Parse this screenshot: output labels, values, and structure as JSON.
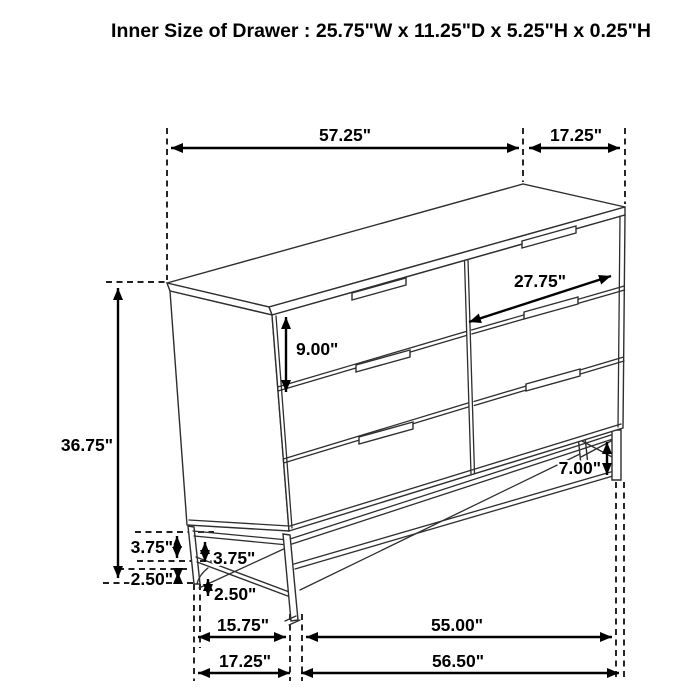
{
  "title": {
    "text": "Inner Size of Drawer : 25.75\"W x 11.25\"D x 5.25\"H x 0.25\"H"
  },
  "figure": {
    "kind": "isometric-line-drawing",
    "subject": "six-drawer dresser on metal leg base",
    "drawer_count_visible": 6,
    "line_color": "#2e2e2e",
    "dimension_color": "#000000",
    "background": "#ffffff"
  },
  "dims": {
    "top_width": "57.25\"",
    "top_depth": "17.25\"",
    "drawer_width": "27.75\"",
    "drawer_front_height": "9.00\"",
    "overall_height": "36.75\"",
    "leg_height_right": "7.00\"",
    "left_upper_outer": "3.75\"",
    "left_upper_inner": "3.75\"",
    "left_lower_outer": "2.50\"",
    "left_lower_inner": "2.50\"",
    "base_depth": "15.75\"",
    "base_width": "55.00\"",
    "floor_depth": "17.25\"",
    "floor_width": "56.50\""
  }
}
